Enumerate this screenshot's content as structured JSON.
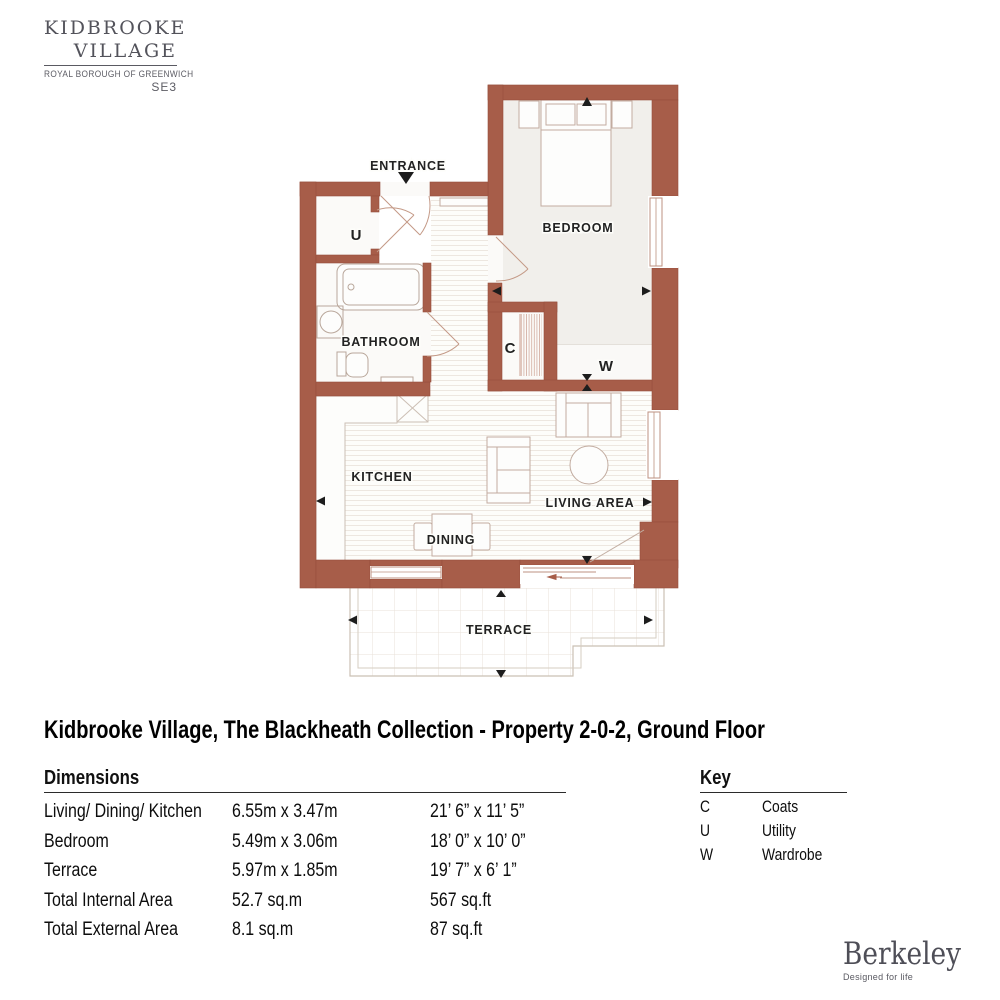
{
  "branding": {
    "estate_logo": {
      "line1": "KIDBROOKE",
      "line2": "VILLAGE",
      "subtitle": "ROYAL BOROUGH OF GREENWICH",
      "postcode": "SE3"
    },
    "developer_logo": {
      "name": "Berkeley",
      "tagline": "Designed for life"
    }
  },
  "title": "Kidbrooke Village, The Blackheath Collection - Property 2-0-2, Ground Floor",
  "plan": {
    "labels": {
      "entrance": "ENTRANCE",
      "utility": "U",
      "bedroom": "BEDROOM",
      "bathroom": "BATHROOM",
      "coats": "C",
      "wardrobe": "W",
      "kitchen": "KITCHEN",
      "living_area": "LIVING AREA",
      "dining": "DINING",
      "terrace": "TERRACE"
    },
    "colors": {
      "wall": "#a75d49",
      "wall_edge": "#964f3c",
      "furniture_line": "#c2aca0",
      "window_frame": "#bd9281",
      "bedroom_floor": "#f1efeb",
      "terrace_line": "#cbc0b4",
      "arrow": "#1d1d1d"
    }
  },
  "dimensions": {
    "heading": "Dimensions",
    "rows": [
      {
        "label": "Living/ Dining/ Kitchen",
        "metric": "6.55m x 3.47m",
        "imperial": "21’ 6” x 11’ 5”"
      },
      {
        "label": "Bedroom",
        "metric": "5.49m x 3.06m",
        "imperial": "18’ 0” x 10’ 0”"
      },
      {
        "label": "Terrace",
        "metric": "5.97m x 1.85m",
        "imperial": "19’ 7” x 6’ 1”"
      },
      {
        "label": "Total Internal Area",
        "metric": "52.7 sq.m",
        "imperial": "567 sq.ft"
      },
      {
        "label": "Total External Area",
        "metric": "8.1 sq.m",
        "imperial": "87 sq.ft"
      }
    ]
  },
  "key": {
    "heading": "Key",
    "rows": [
      {
        "code": "C",
        "meaning": "Coats"
      },
      {
        "code": "U",
        "meaning": "Utility"
      },
      {
        "code": "W",
        "meaning": "Wardrobe"
      }
    ]
  }
}
